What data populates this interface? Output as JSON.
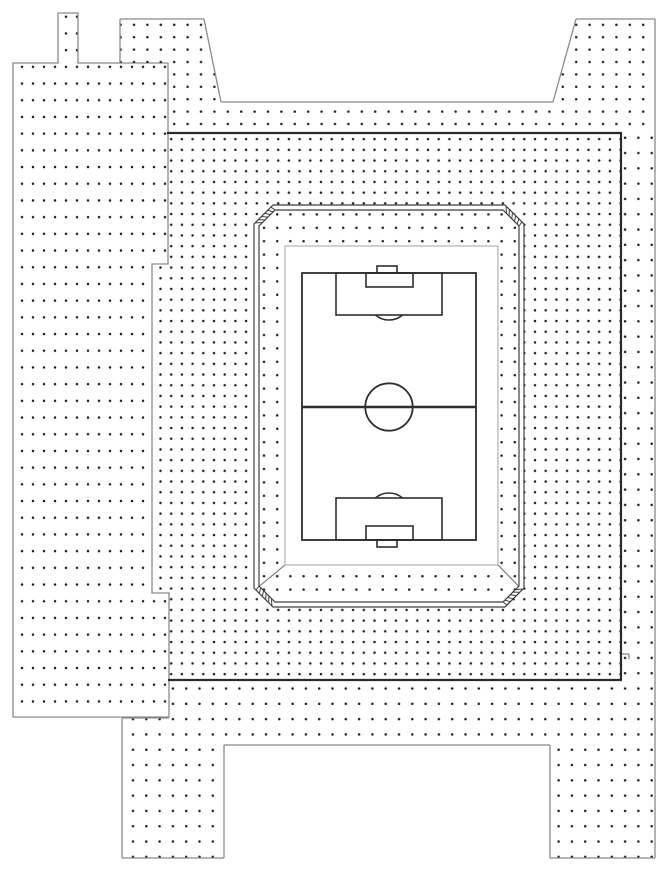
{
  "drawing": {
    "name": "stadium-site-plan",
    "canvas": {
      "width": 666,
      "height": 879,
      "background": "#ffffff"
    },
    "colors": {
      "zone_line": "#8a8a8a",
      "dense_border": "#2b2b2b",
      "dot": "#1f1f1f",
      "wall_line": "#3f3f3f",
      "pitch_line": "#2e2e2e",
      "field_outline": "#a3a3a3",
      "ramp_line": "#6f6f6f"
    },
    "dot_patterns": [
      {
        "id": "pA",
        "dx": 11,
        "dy": 16.7,
        "r": 1.25
      },
      {
        "id": "pB",
        "dx": 13.4,
        "dy": 12.4,
        "r": 1.25
      },
      {
        "id": "pC",
        "dx": 10.7,
        "dy": 10.7,
        "r": 1.25
      },
      {
        "id": "pD",
        "dx": 13.3,
        "dy": 15.3,
        "r": 1.25
      },
      {
        "id": "pE",
        "dx": 13.2,
        "dy": 13.4,
        "r": 1.25
      }
    ],
    "zones": [
      {
        "name": "left-terrace",
        "pattern": "pA",
        "stroke": true,
        "evenodd": false,
        "path": "M13,63 L58,63 L58,13 L78,13 L78,63 L168,63 L168,264 L152,264 L152,593 L169,593 L169,717 L13,717 Z"
      },
      {
        "name": "top-terrace",
        "pattern": "pB",
        "stroke": false,
        "evenodd": false,
        "path": "M120,63 L120,19 L204,19 L221,102 L553,102 L576,19 L655,19 L655,133 L168,133 L168,63 Z"
      },
      {
        "name": "outer-concourse",
        "pattern": "pD",
        "stroke": false,
        "evenodd": false,
        "path": "M169,680 L622,680 L622,133 L655,133 L655,858 L550,858 L550,745 L224,745 L224,858 L122,858 L122,718 L169,718 Z"
      },
      {
        "name": "inner-concourse",
        "pattern": "pC",
        "stroke": false,
        "evenodd": true,
        "path": "M168,133 L621,133 L621,680 L169,680 L169,593 L152,593 L152,264 L168,264 Z M273,205 L505,205 L524,224 L524,588 L505,607 L273,607 L254,588 L254,224 Z"
      },
      {
        "name": "stand-apron",
        "pattern": "pE",
        "stroke": false,
        "evenodd": false,
        "path": "M275,210 L503,210 L519,226 L519,586 L503,602 L275,602 L259,586 L259,226 Z"
      }
    ],
    "boundary_lines": [
      {
        "x1": 120,
        "y1": 63,
        "x2": 120,
        "y2": 19
      },
      {
        "x1": 120,
        "y1": 19,
        "x2": 204,
        "y2": 19
      },
      {
        "x1": 204,
        "y1": 19,
        "x2": 221,
        "y2": 102
      },
      {
        "x1": 221,
        "y1": 102,
        "x2": 553,
        "y2": 102
      },
      {
        "x1": 553,
        "y1": 102,
        "x2": 576,
        "y2": 19
      },
      {
        "x1": 576,
        "y1": 19,
        "x2": 655,
        "y2": 19
      },
      {
        "x1": 655,
        "y1": 19,
        "x2": 655,
        "y2": 858
      },
      {
        "x1": 550,
        "y1": 858,
        "x2": 655,
        "y2": 858
      },
      {
        "x1": 550,
        "y1": 745,
        "x2": 550,
        "y2": 858
      },
      {
        "x1": 224,
        "y1": 745,
        "x2": 550,
        "y2": 745
      },
      {
        "x1": 224,
        "y1": 745,
        "x2": 224,
        "y2": 858
      },
      {
        "x1": 122,
        "y1": 858,
        "x2": 224,
        "y2": 858
      },
      {
        "x1": 122,
        "y1": 718,
        "x2": 122,
        "y2": 858
      },
      {
        "x1": 122,
        "y1": 718,
        "x2": 169,
        "y2": 718
      },
      {
        "x1": 621,
        "y1": 654,
        "x2": 629,
        "y2": 654
      },
      {
        "x1": 629,
        "y1": 654,
        "x2": 629,
        "y2": 659
      }
    ],
    "dense_border_lines": [
      {
        "x1": 167,
        "y1": 133,
        "x2": 622,
        "y2": 133
      },
      {
        "x1": 621,
        "y1": 133,
        "x2": 621,
        "y2": 680
      },
      {
        "x1": 168,
        "y1": 680,
        "x2": 622,
        "y2": 680
      }
    ],
    "ramp_lines": [
      {
        "x1": 285,
        "y1": 565,
        "x2": 259.5,
        "y2": 586
      },
      {
        "x1": 498,
        "y1": 565,
        "x2": 518.5,
        "y2": 586
      }
    ],
    "wall": {
      "outer": "M273,205 L505,205 L524,224 L524,588 L505,607 L273,607 L254,588 L254,224 Z",
      "inner": "M275,210 L503,210 L519,226 L519,586 L503,602 L275,602 L259,586 L259,226 Z",
      "chamfers": [
        {
          "o1": [
            254,
            224
          ],
          "o2": [
            273,
            205
          ],
          "i1": [
            259,
            226
          ],
          "i2": [
            275,
            210
          ]
        },
        {
          "o1": [
            505,
            205
          ],
          "o2": [
            524,
            224
          ],
          "i1": [
            503,
            210
          ],
          "i2": [
            519,
            226
          ]
        },
        {
          "o1": [
            524,
            588
          ],
          "o2": [
            505,
            607
          ],
          "i1": [
            519,
            586
          ],
          "i2": [
            503,
            602
          ]
        },
        {
          "o1": [
            273,
            607
          ],
          "o2": [
            254,
            588
          ],
          "i1": [
            275,
            602
          ],
          "i2": [
            259,
            586
          ]
        }
      ],
      "ticks_per_chamfer": 6
    },
    "field": {
      "surround": {
        "x": 285,
        "y": 246,
        "w": 213,
        "h": 319
      },
      "pitch": {
        "x": 302,
        "y": 273,
        "w": 174,
        "h": 267
      },
      "markings": [
        {
          "name": "halfway-line",
          "type": "line",
          "x1": 302,
          "y1": 407,
          "x2": 476,
          "y2": 407,
          "w": 2.6
        },
        {
          "name": "center-circle",
          "type": "circle",
          "cx": 389,
          "cy": 407,
          "r": 23.7
        },
        {
          "name": "penalty-area-top",
          "type": "rect",
          "x": 336,
          "y": 273,
          "w": 106,
          "h": 42
        },
        {
          "name": "goal-area-top",
          "type": "rect",
          "x": 366,
          "y": 273,
          "w": 47,
          "h": 14
        },
        {
          "name": "goal-top",
          "type": "rect",
          "x": 377,
          "y": 266,
          "w": 20,
          "h": 7
        },
        {
          "name": "penalty-arc-top",
          "type": "path",
          "d": "M375.4,315 A21,21 0 0 0 402.6,315"
        },
        {
          "name": "penalty-area-bottom",
          "type": "rect",
          "x": 336,
          "y": 498,
          "w": 106,
          "h": 42
        },
        {
          "name": "goal-area-bottom",
          "type": "rect",
          "x": 366,
          "y": 526,
          "w": 47,
          "h": 14
        },
        {
          "name": "goal-bottom",
          "type": "rect",
          "x": 377,
          "y": 540,
          "w": 20,
          "h": 7
        },
        {
          "name": "penalty-arc-bottom",
          "type": "path",
          "d": "M375.4,498 A21,21 0 0 1 402.6,498"
        }
      ]
    }
  }
}
